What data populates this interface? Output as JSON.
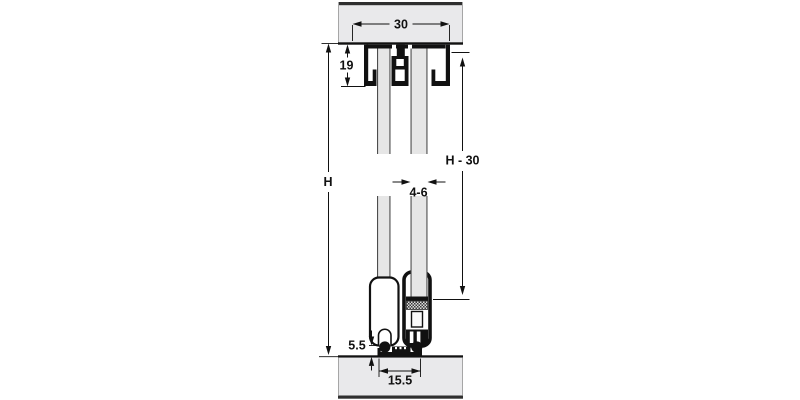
{
  "diagram": {
    "dimension_labels": {
      "track_width": "30",
      "track_height": "19",
      "overall_height": "H",
      "door_height": "H - 30",
      "glass_thickness": "4-6",
      "floor_clearance": "5.5",
      "floor_guide_width": "15.5"
    },
    "colors": {
      "wall_fill": "#e9e9eb",
      "wall_edge_dark": "#2f2f2f",
      "outline": "#111111",
      "glass_fill": "#e6e6e6",
      "glass_edge": "#4d4d4d"
    }
  }
}
